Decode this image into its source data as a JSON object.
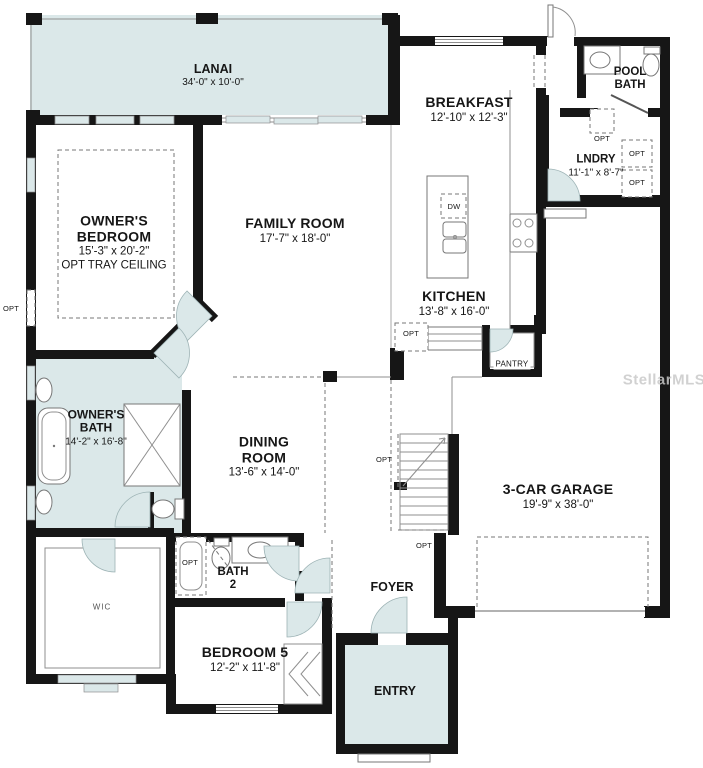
{
  "watermark": "StellarMLS",
  "rooms": {
    "lanai": {
      "name": "LANAI",
      "dims": "34'-0\" x 10'-0\""
    },
    "owners_bedroom": {
      "name": "OWNER'S BEDROOM",
      "dims": "15'-3\" x 20'-2\"",
      "note": "OPT TRAY CEILING"
    },
    "family_room": {
      "name": "FAMILY ROOM",
      "dims": "17'-7\" x 18'-0\""
    },
    "breakfast": {
      "name": "BREAKFAST",
      "dims": "12'-10\" x 12'-3\""
    },
    "pool_bath": {
      "name": "POOL BATH"
    },
    "laundry": {
      "name": "LNDRY",
      "dims": "11'-1\" x 8'-7\""
    },
    "kitchen": {
      "name": "KITCHEN",
      "dims": "13'-8\" x 16'-0\""
    },
    "pantry": {
      "name": "PANTRY"
    },
    "owners_bath": {
      "name": "OWNER'S BATH",
      "dims": "14'-2\" x 16'-8\""
    },
    "dining_room": {
      "name": "DINING ROOM",
      "dims": "13'-6\" x 14'-0\""
    },
    "garage": {
      "name": "3-CAR GARAGE",
      "dims": "19'-9\" x 38'-0\""
    },
    "wic": {
      "name": "WIC"
    },
    "bath2": {
      "name": "BATH 2"
    },
    "foyer": {
      "name": "FOYER"
    },
    "bedroom5": {
      "name": "BEDROOM 5",
      "dims": "12'-2\" x 11'-8\""
    },
    "entry": {
      "name": "ENTRY"
    }
  },
  "labels": {
    "opt": "OPT",
    "dw": "DW"
  },
  "colors": {
    "wall": "#161616",
    "room_fill": "#dbe8e9",
    "line_gray": "#8f8f8f",
    "watermark": "#c9c9c9"
  }
}
